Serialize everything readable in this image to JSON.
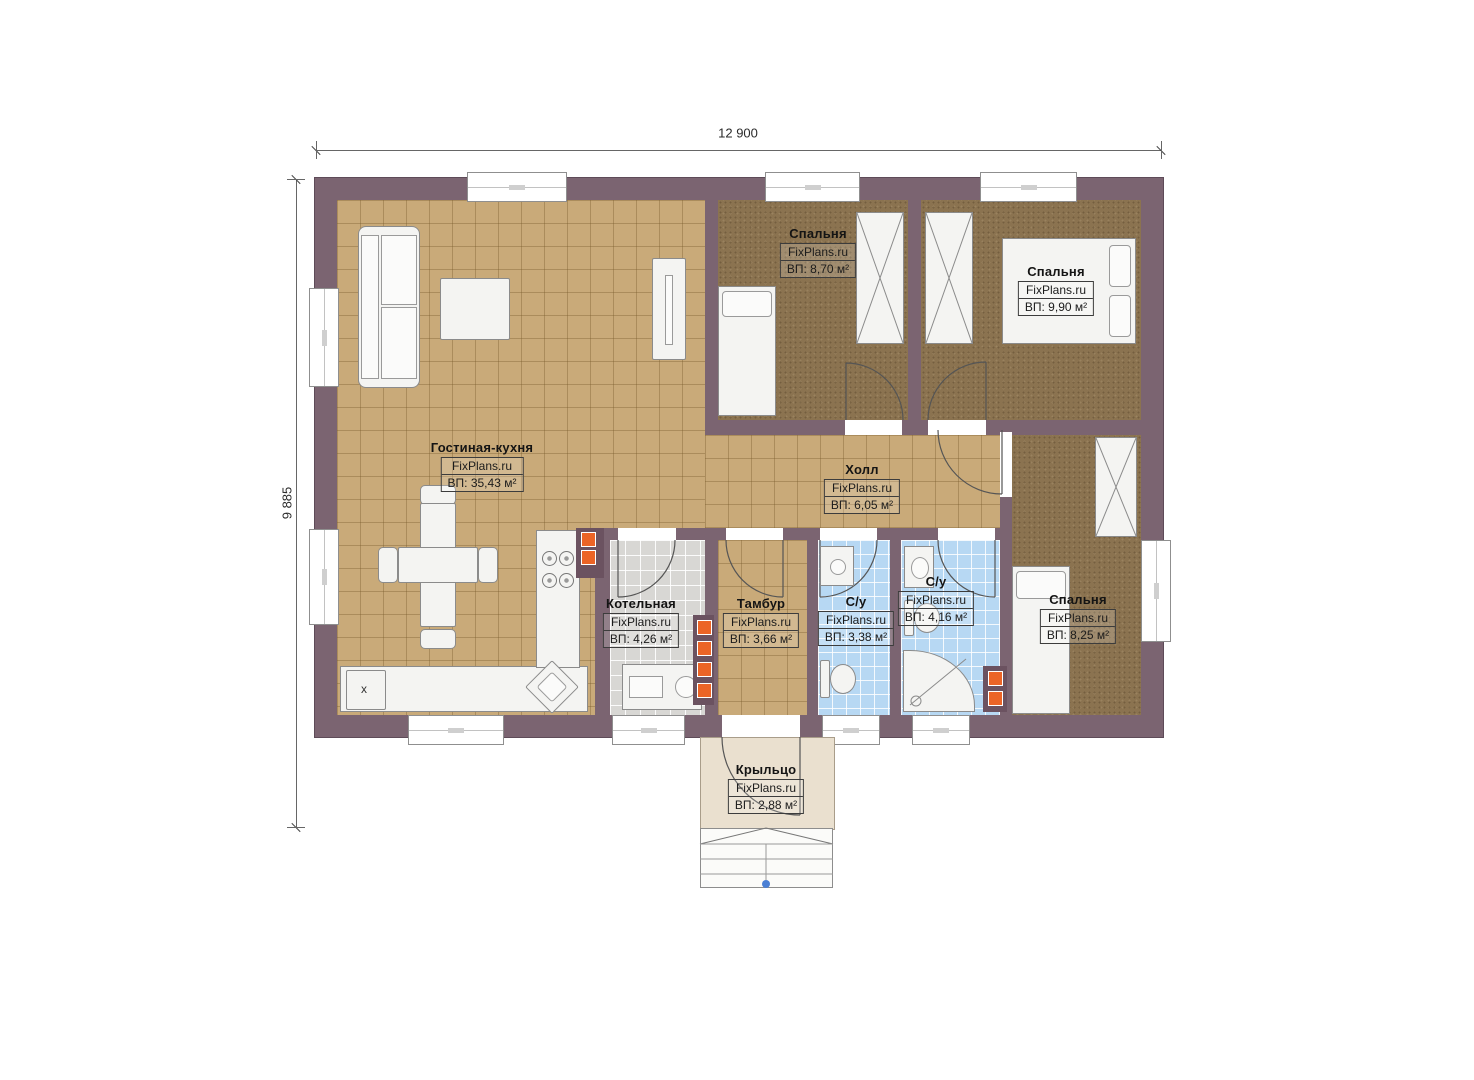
{
  "dims": {
    "width": "12 900",
    "height": "9 885"
  },
  "watermark": "FixPlans.ru",
  "rooms": [
    {
      "id": "living",
      "name": "Гостиная-кухня",
      "watermark": "FixPlans.ru",
      "area": "ВП: 35,43 м²"
    },
    {
      "id": "bedroom-1",
      "name": "Спальня",
      "watermark": "FixPlans.ru",
      "area": "ВП: 8,70 м²"
    },
    {
      "id": "bedroom-2",
      "name": "Спальня",
      "watermark": "FixPlans.ru",
      "area": "ВП: 9,90 м²"
    },
    {
      "id": "hall",
      "name": "Холл",
      "watermark": "FixPlans.ru",
      "area": "ВП: 6,05 м²"
    },
    {
      "id": "boiler-room",
      "name": "Котельная",
      "watermark": "FixPlans.ru",
      "area": "ВП: 4,26 м²"
    },
    {
      "id": "vestibule",
      "name": "Тамбур",
      "watermark": "FixPlans.ru",
      "area": "ВП: 3,66 м²"
    },
    {
      "id": "bathroom-1",
      "name": "С/у",
      "watermark": "FixPlans.ru",
      "area": "ВП: 3,38 м²"
    },
    {
      "id": "bathroom-2",
      "name": "С/у",
      "watermark": "FixPlans.ru",
      "area": "ВП: 4,16 м²"
    },
    {
      "id": "bedroom-3",
      "name": "Спальня",
      "watermark": "FixPlans.ru",
      "area": "ВП: 8,25 м²"
    },
    {
      "id": "porch",
      "name": "Крыльцо",
      "watermark": "FixPlans.ru",
      "area": "ВП: 2,88 м²"
    }
  ],
  "annotations": {
    "fridge": "x"
  },
  "colors": {
    "wall": "#7b6471",
    "tile_tan": "#c9aa79",
    "floor_bedroom": "#8b7350",
    "floor_bath": "#b7d8f3",
    "floor_boiler": "#d8d7d4",
    "floor_porch": "#eae0cf",
    "vent_orange": "#ec6426",
    "entry_dot_blue": "#4a7fd4"
  }
}
